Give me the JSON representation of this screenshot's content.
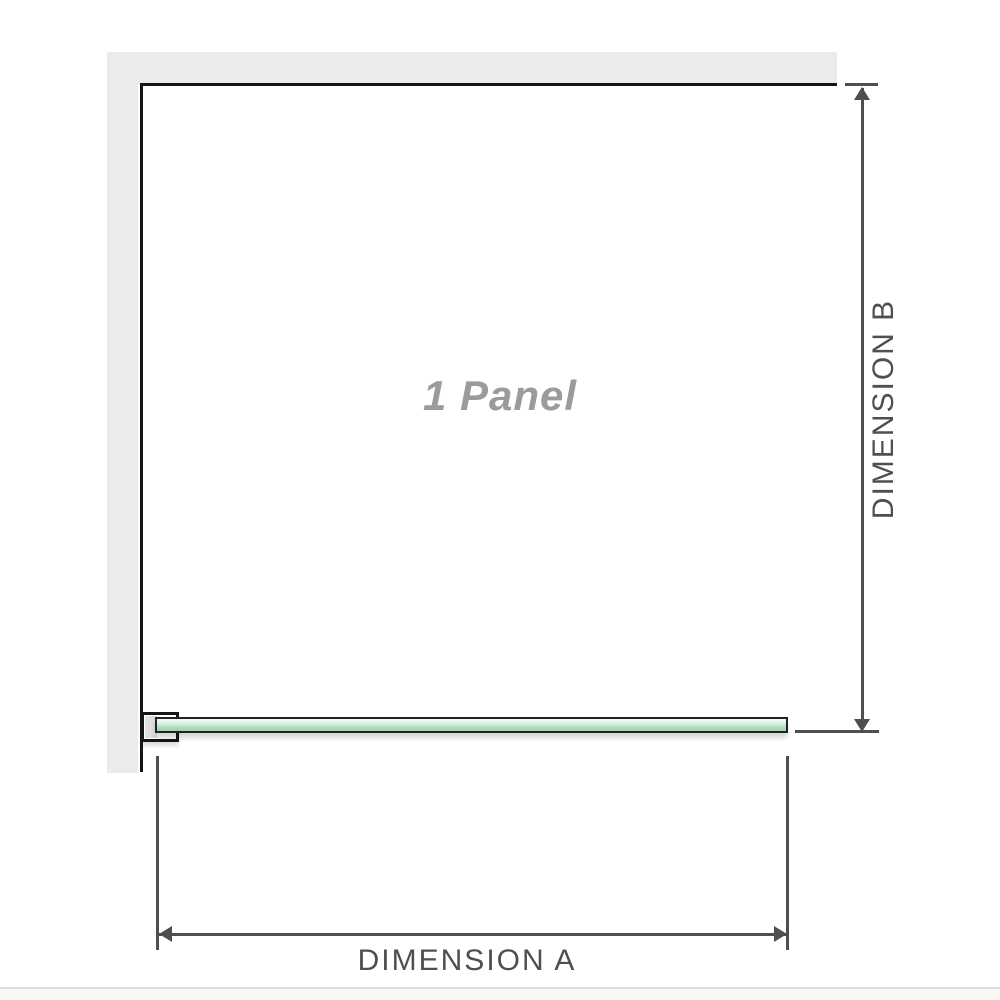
{
  "diagram": {
    "panel_label": "1 Panel",
    "dimension_a": {
      "label": "DIMENSION A"
    },
    "dimension_b": {
      "label": "DIMENSION B"
    }
  },
  "colors": {
    "wall_fill": "#ebebeb",
    "outline": "#161616",
    "dimension": "#4f4f4f",
    "panel_label_text": "#9b9b9b",
    "glass_border": "#222222",
    "glass_green": "#a9dabb",
    "glass_green_light": "#e4f3e9",
    "bracket_pad_fill": "#d6d6d6",
    "separator": "#dcdcdc"
  }
}
